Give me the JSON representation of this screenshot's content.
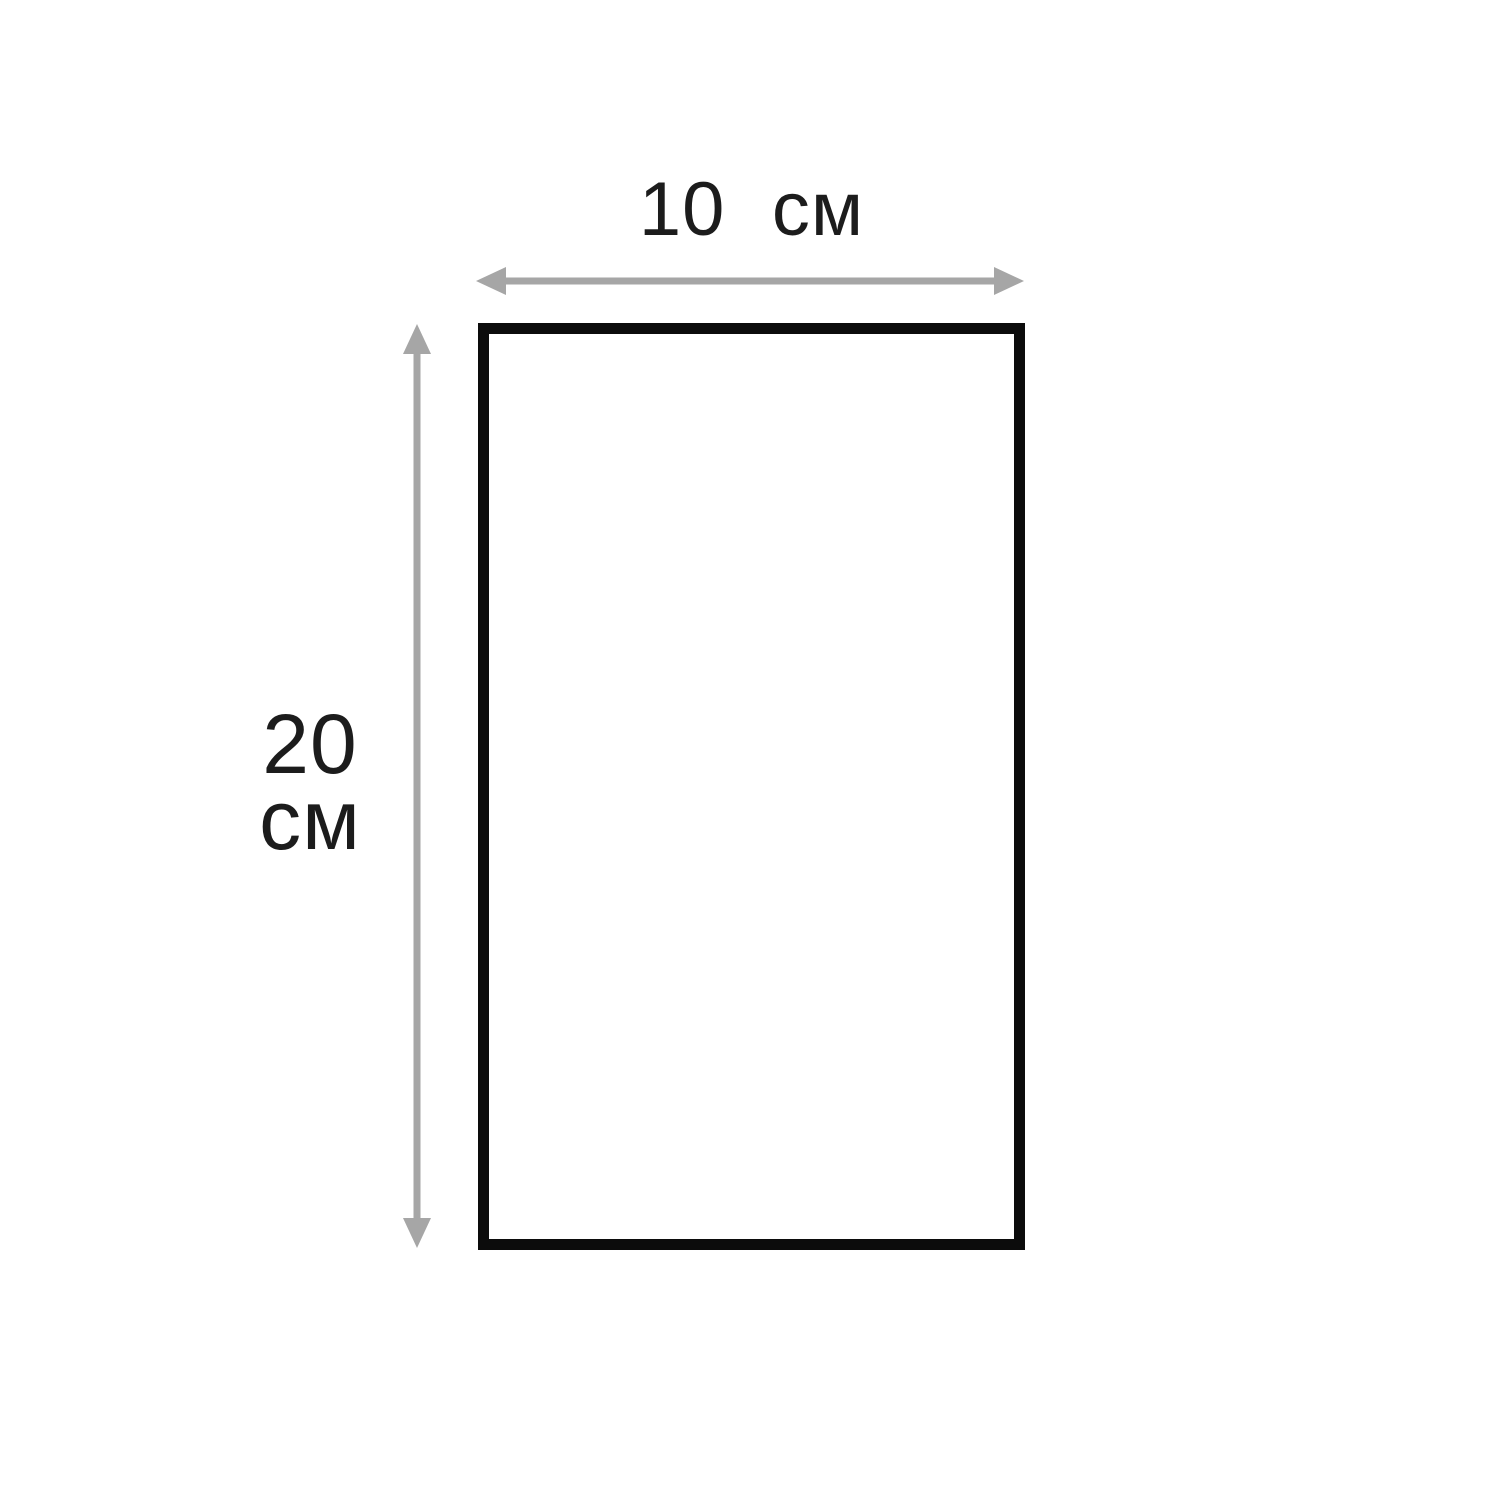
{
  "diagram": {
    "shape": "rectangle",
    "labels": {
      "width": {
        "value": "10",
        "unit": "см"
      },
      "height": {
        "value": "20",
        "unit": "см"
      }
    }
  },
  "colors": {
    "background": "#ffffff",
    "shape_border": "#0c0c0c",
    "arrow": "#a6a6a6",
    "text": "#1c1c1c"
  }
}
